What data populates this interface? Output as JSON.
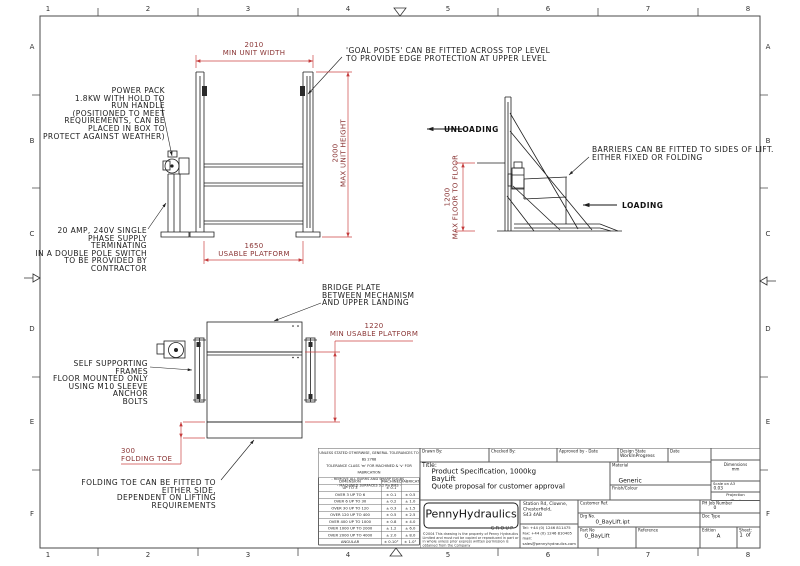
{
  "colors": {
    "dim_red": "#cc4545",
    "dim_text": "#8a3535",
    "linework": "#1f1f1f",
    "frame": "#4a4a4a"
  },
  "border": {
    "columns": [
      "1",
      "2",
      "3",
      "4",
      "5",
      "6",
      "7",
      "8"
    ],
    "rows": [
      "A",
      "B",
      "C",
      "D",
      "E",
      "F"
    ]
  },
  "notes": {
    "power_pack": "POWER PACK\n1.8KW WITH HOLD TO\nRUN HANDLE\n(POSITIONED TO MEET\nREQUIREMENTS, CAN BE\nPLACED IN BOX TO\nPROTECT AGAINST WEATHER)",
    "supply": "20 AMP, 240V SINGLE\nPHASE SUPPLY TERMINATING\nIN A DOUBLE POLE SWITCH\nTO BE PROVIDED BY\nCONTRACTOR",
    "goal_posts": "'GOAL POSTS' CAN BE FITTED ACROSS TOP LEVEL\nTO PROVIDE EDGE PROTECTION AT UPPER LEVEL",
    "barriers": "BARRIERS CAN BE FITTED TO SIDES OF LIFT.\nEITHER FIXED OR FOLDING",
    "bridge_plate": "BRIDGE PLATE\nBETWEEN MECHANISM\nAND UPPER LANDING",
    "self_supporting": "SELF SUPPORTING FRAMES\nFLOOR MOUNTED ONLY\nUSING M10 SLEEVE ANCHOR\nBOLTS",
    "folding_toe": "FOLDING TOE CAN BE FITTED TO EITHER SIDE,\nDEPENDENT ON LIFTING REQUIREMENTS",
    "unloading": "UNLOADING",
    "loading": "LOADING"
  },
  "dims": {
    "unit_width": "2010\nMIN UNIT WIDTH",
    "unit_height": "2000\nMAX UNIT HEIGHT",
    "usable_platform": "1650\nUSABLE PLATFORM",
    "floor_to_floor": "1200\nMAX FLOOR TO FLOOR",
    "min_usable_platform": "1220\nMIN USABLE PLATFORM",
    "folding_toe": "300\nFOLDING TOE"
  },
  "tolerance": {
    "note": "UNLESS STATED OTHERWISE, GENERAL TOLERANCES TO BS 2768\nTOLERANCE CLASS 'm' FOR MACHINED & 'v' FOR FABRICATION\n- REMOVE ALL BURRS AND SHARP EDGES -\n- MACHINED SURFACES 3.2 Ra RMS -",
    "headers": [
      "DIMENSION",
      "MACHINED",
      "FABRICATED"
    ],
    "rows": [
      [
        "UP TO 3",
        "± 0.1",
        ""
      ],
      [
        "OVER 3 UP TO 6",
        "± 0.1",
        "± 0.5"
      ],
      [
        "OVER 6 UP TO 30",
        "± 0.2",
        "± 1.0"
      ],
      [
        "OVER 30 UP TO 120",
        "± 0.3",
        "± 1.5"
      ],
      [
        "OVER 120 UP TO 400",
        "± 0.5",
        "± 2.5"
      ],
      [
        "OVER 400 UP TO 1000",
        "± 0.8",
        "± 4.0"
      ],
      [
        "OVER 1000 UP TO 2000",
        "± 1.2",
        "± 6.0"
      ],
      [
        "OVER 2000 UP TO 4000",
        "± 2.0",
        "± 8.0"
      ],
      [
        "ANGULAR",
        "± 0.10°",
        "± 1.0°"
      ]
    ]
  },
  "title_block": {
    "drawn_by": "Drawn By:",
    "checked_by": "Checked By:",
    "approved_by": "Approved by - Date",
    "design_state_label": "Design State",
    "design_state_value": "WorkInProgress",
    "date_label": "Date",
    "title_label": "Title:",
    "title_value": "Product Specification, 1000kg\nBayLift\nQuote proposal for customer approval",
    "material_label": "Material",
    "material_value": "Generic",
    "finish_label": "Finish/Colour",
    "dimensions_label": "Dimensions\nmm",
    "scale_label": "Scale on A3",
    "scale_value": "0.03",
    "projection_label": "Projection",
    "company_name": "PennyHydraulics",
    "company_group": "GROUP",
    "copyright": "©2004 This drawing is the property of Penny Hydraulics Limited and must not be copied or reproduced in part or in whole unless prior express written permission is obtained from the Company",
    "address": "Station Rd, Clowne,\nChesterfield,\nS43 4AB",
    "contact": "Tel:  +44 (0) 1246 811475\nFax: +44 (0) 1246 810405\nmail: sales@pennyhydraulics.com\nweb: www.pennyhydraulics.com",
    "customer_ref_label": "Customer Ref.",
    "drg_no_label": "Drg No.",
    "drg_no_value": "0_BayLift.ipt",
    "part_no_label": "Part No",
    "part_no_value": "0_BayLift",
    "reference_label": "Reference",
    "ph_job_label": "PH Job Number",
    "ph_job_value": "0",
    "doc_type_label": "Doc Type",
    "edition_label": "Edition",
    "edition_value": "A",
    "sheet_label": "Sheet:",
    "sheet_value": "1  of"
  }
}
